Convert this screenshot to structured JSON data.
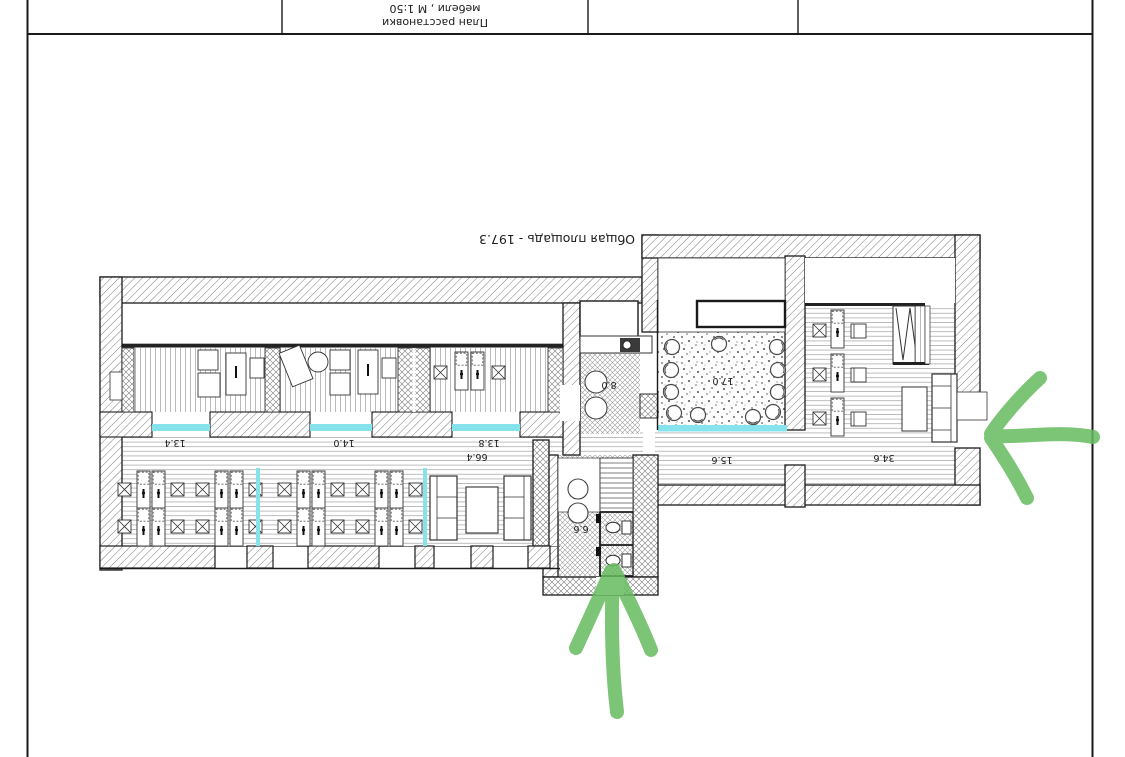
{
  "sheet": {
    "title_block": {
      "plan_title_line1": "План расстановки",
      "plan_title_line2": "мебели , М 1:50"
    },
    "total_area_note": "Общая площадь - 197.3"
  },
  "plan": {
    "room_areas": {
      "cabinet_1": "13.4",
      "cabinet_2": "14.0",
      "cabinet_3": "13.8",
      "kitchen": "8.0",
      "meeting_room": "17.0",
      "hall": "15.6",
      "director_office": "34.6",
      "open_space": "66.4",
      "wc": "6.6"
    },
    "colors": {
      "annotation_green": "#67bb5f",
      "threshold_cyan": "#86e3ec"
    }
  }
}
